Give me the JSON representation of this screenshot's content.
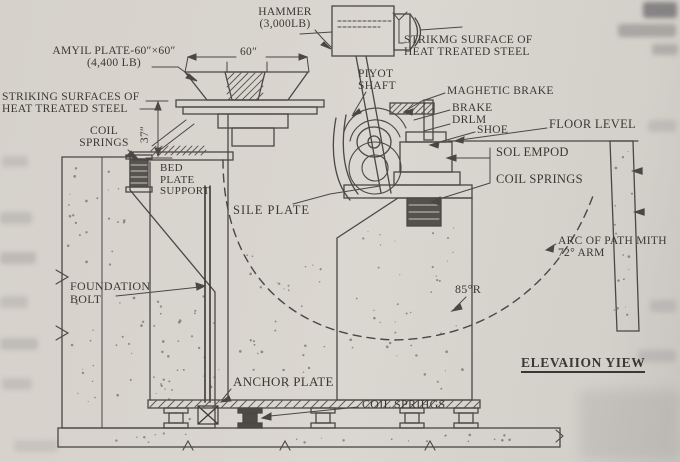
{
  "diagram": {
    "view_title": "ELEVAIION YIEW",
    "labels": {
      "hammer1": "HAMMER",
      "hammer2": "(3,000LB)",
      "strike_right1": "STRIKMG SURFACE OF",
      "strike_right2": "HEAT TREATED STEEL",
      "anvil1": "AMYIL PLATE-60″×60″",
      "anvil2": "(4,400 LB)",
      "strike_left1": "STRIKING SURFACES OF",
      "strike_left2": "HEAT TREATED STEEL",
      "coil_left1": "COIL",
      "coil_left2": "SPRINGS",
      "pivot1": "PIYOT",
      "pivot2": "SHAFT",
      "magnetic_brake": "MAGHETIC BRAKE",
      "brake1": "BRAKE",
      "brake2": "DRLM",
      "shoe": "SHOE",
      "floor_level": "FLOOR LEVEL",
      "sole_support": "SOL EMPOD",
      "coil_right": "COIL SPRINGS",
      "bed1": "BED",
      "bed2": "PLATE",
      "bed3": "SUPPORT",
      "sole_plate": "SILE PLATE",
      "arc1": "ARC OF PATH MITH",
      "arc2": "72° ARM",
      "radius": "85°R",
      "foundation1": "FOUNDATION",
      "foundation2": "BOLT",
      "anchor_plate": "ANCHOR PLATE",
      "coil_bottom": "COIL SPRIHGS",
      "dim_width": "60″",
      "dim_height": "37″"
    },
    "colors": {
      "paper": "#d8d4ce",
      "ink": "#4a4744",
      "label_ink": "#3b3833"
    }
  }
}
